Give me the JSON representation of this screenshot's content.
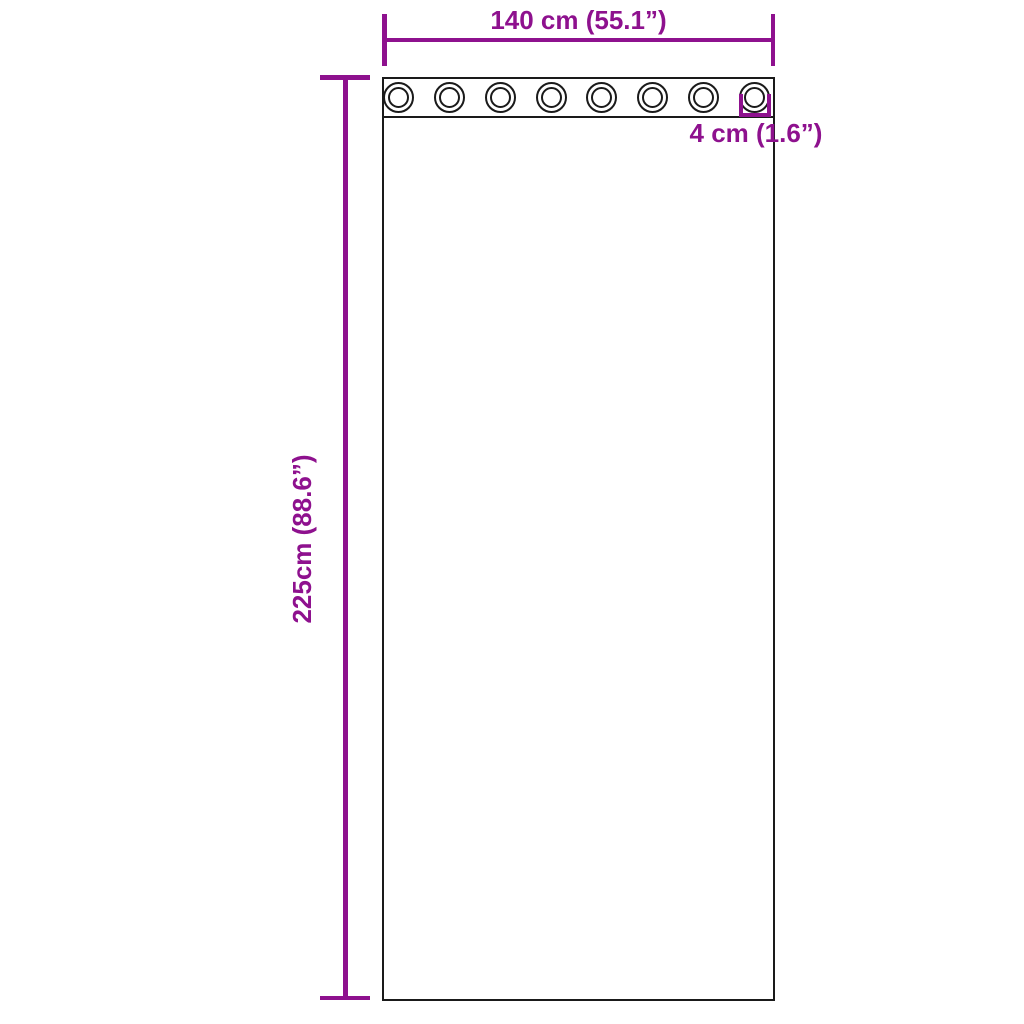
{
  "diagram": {
    "accent_color": "#8e118e",
    "outline_color": "#1a1a1a",
    "background_color": "#ffffff",
    "grommets": {
      "count": 8
    },
    "dimensions": {
      "width": {
        "value": "140 cm (55.1”)"
      },
      "height": {
        "value": "225cm (88.6”)"
      },
      "grommet_diameter": {
        "value": "4 cm (1.6”)"
      }
    }
  }
}
